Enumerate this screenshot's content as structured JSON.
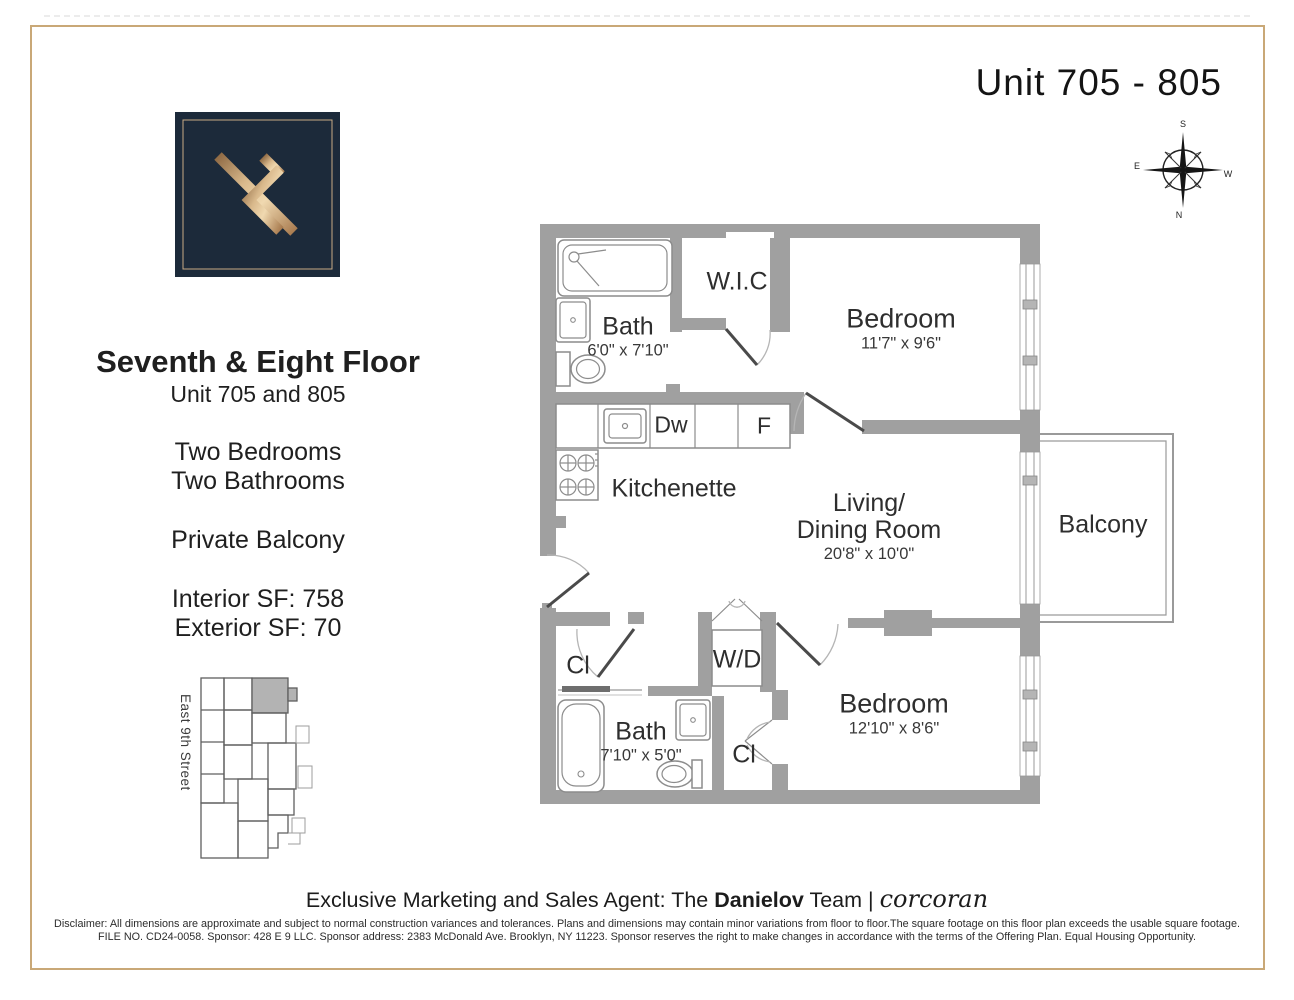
{
  "page": {
    "unit_title": "Unit 705 - 805"
  },
  "left_panel": {
    "heading": "Seventh & Eight Floor",
    "subheading": "Unit 705 and 805",
    "two_bedrooms": "Two Bedrooms",
    "two_bathrooms": "Two Bathrooms",
    "private_balcony": "Private Balcony",
    "interior_sf": "Interior SF: 758",
    "exterior_sf": "Exterior SF: 70",
    "street_label": "East 9th Street"
  },
  "compass": {
    "n": "N",
    "s": "S",
    "e": "E",
    "w": "W"
  },
  "floor_plan": {
    "bath1": {
      "label": "Bath",
      "dims": "6'0\" x 7'10\""
    },
    "wic": {
      "label": "W.I.C"
    },
    "bedroom1": {
      "label": "Bedroom",
      "dims": "11'7\" x 9'6\""
    },
    "dw": "Dw",
    "fridge": "F",
    "kitchenette": "Kitchenette",
    "living": {
      "line1": "Living/",
      "line2": "Dining Room",
      "dims": "20'8\" x 10'0\""
    },
    "balcony": "Balcony",
    "closet1": "Cl",
    "wd": "W/D",
    "bath2": {
      "label": "Bath",
      "dims": "7'10\" x 5'0\""
    },
    "closet2": "Cl",
    "bedroom2": {
      "label": "Bedroom",
      "dims": "12'10\" x 8'6\""
    }
  },
  "footer": {
    "agent_prefix": "Exclusive Marketing and Sales Agent: The ",
    "agent_bold": "Danielov",
    "agent_suffix": " Team | ",
    "brand": "corcoran",
    "disclaimer_line1": "Disclaimer: All dimensions are approximate and subject to normal construction variances and tolerances. Plans and dimensions may contain minor variations from floor to floor.The square footage on this floor plan exceeds the usable square footage.",
    "disclaimer_line2": "FILE NO. CD24-0058. Sponsor: 428 E 9 LLC. Sponsor address: 2383 McDonald Ave. Brooklyn, NY 11223. Sponsor reserves the right to make changes in accordance with the terms of the Offering Plan. Equal Housing Opportunity."
  },
  "colors": {
    "accent_gold": "#c9a877",
    "wall_gray": "#a0a0a0",
    "logo_navy": "#1c2a3a",
    "logo_gold": "#c19a6b",
    "keyplan_highlight": "#b3b3b3"
  }
}
